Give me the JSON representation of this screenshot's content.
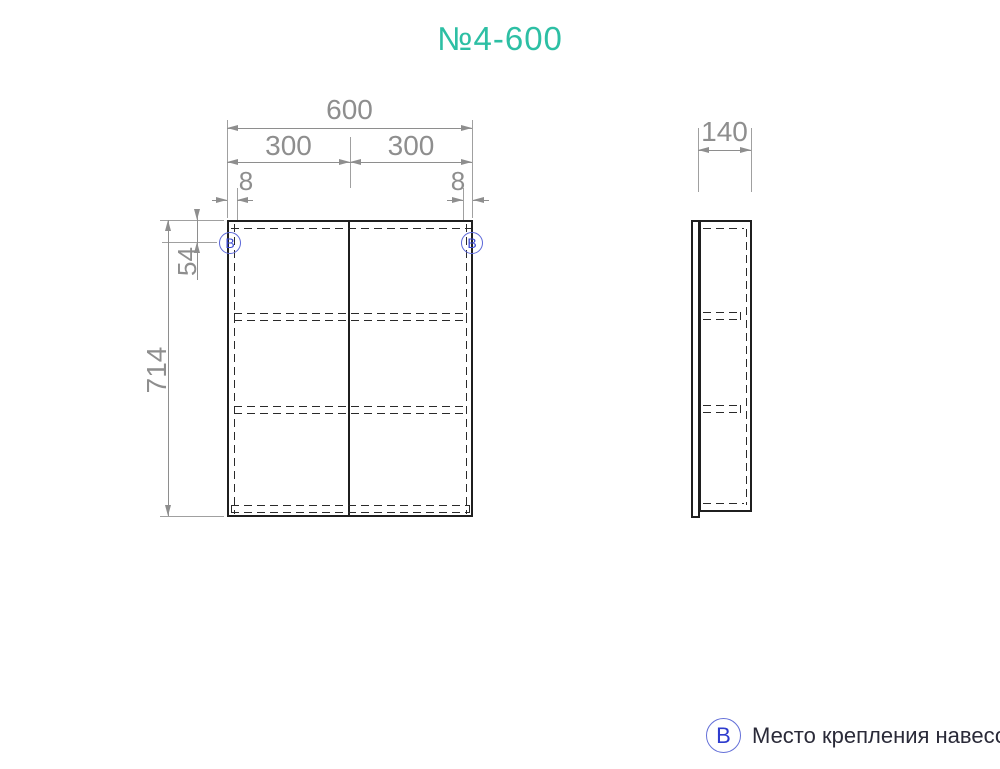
{
  "title": "№4-600",
  "front_view": {
    "hinge_marker": "В",
    "dims": {
      "total_width": "600",
      "left_door": "300",
      "right_door": "300",
      "left_offset": "8",
      "right_offset": "8",
      "height": "714",
      "hinge_offset": "54"
    }
  },
  "side_view": {
    "dims": {
      "depth": "140"
    }
  },
  "legend": {
    "symbol": "В",
    "text": "Место крепления навесов"
  },
  "colors": {
    "title_teal": "#2dbfa4",
    "marker_blue": "#3b49d2",
    "dimension_gray": "#8e8e8e",
    "drawing_black": "#1f1f1f",
    "legend_text": "#2a2a38"
  }
}
